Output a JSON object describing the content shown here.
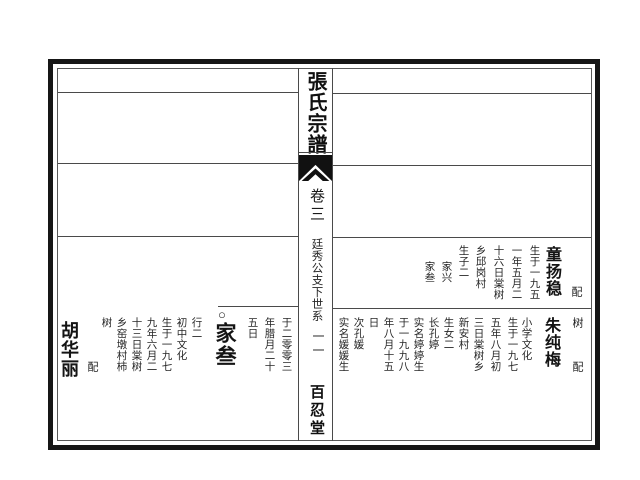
{
  "center_column": {
    "title": "張氏宗譜",
    "volume": "卷三",
    "section": "廷秀公支下世系",
    "page_number": "一一",
    "hall": "百忍堂"
  },
  "right_page": {
    "row_tong": {
      "spouse_label": "配",
      "spouse_name": "童扬稳",
      "details": [
        "生于一九五",
        "一年五月二",
        "十六日棠树",
        "乡邱岗村",
        "生子二"
      ],
      "sons": [
        "家兴",
        "家叁"
      ]
    },
    "row_zhu": {
      "carryover": "树",
      "spouse_label": "配",
      "spouse_name": "朱纯梅",
      "details": [
        "小学文化",
        "生于一九七",
        "五年八月初",
        "三日棠树乡",
        "新安村",
        "生女二",
        "长孔婷",
        "实名婷婷生",
        "于一九九八",
        "年八月十五",
        "日",
        "次孔媛",
        "实名媛媛生"
      ]
    }
  },
  "left_page": {
    "carryover_cols": [
      "于二零零三",
      "年腊月二十",
      "五日"
    ],
    "entry": {
      "marker": "○",
      "name": "家叁",
      "details": [
        "行二",
        "初中文化",
        "生于一九七",
        "九年六月二",
        "十三日棠树",
        "乡窑墩村柿",
        "树"
      ],
      "spouse_label": "配",
      "spouse_name": "胡华丽"
    }
  }
}
